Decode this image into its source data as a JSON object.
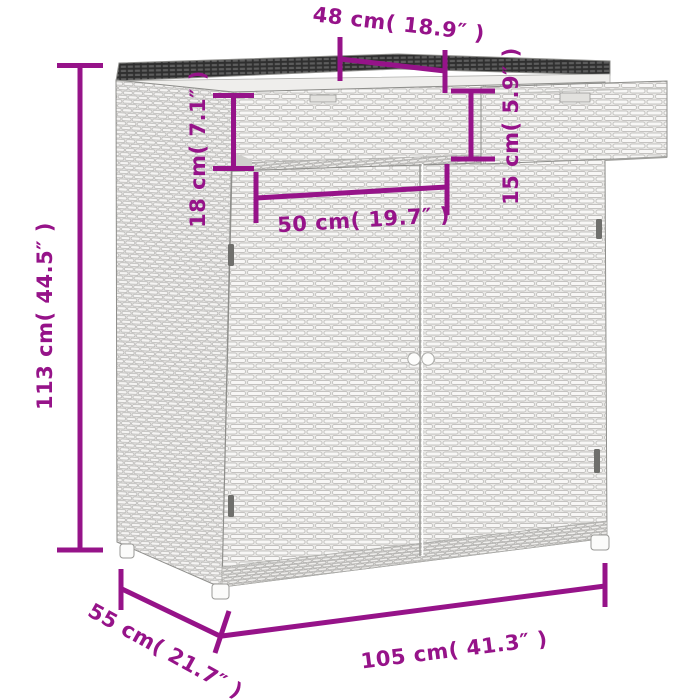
{
  "figure": {
    "type": "product-dimension-diagram"
  },
  "dimensions": {
    "top_width": "48 cm( 18.9″ )",
    "top_section_height": "18 cm( 7.1″ )",
    "extension_height": "15 cm( 5.9″ )",
    "door_width": "50 cm( 19.7″ )",
    "total_height": "113 cm( 44.5″ )",
    "depth": "55 cm( 21.7″ )",
    "total_width": "105 cm( 41.3″ )"
  },
  "colors": {
    "dimension_annotation": "#961389",
    "background": "#ffffff",
    "wicker_light": "#f0efed",
    "wicker_shade": "#b5b4b1",
    "top_dark": "#3d3d3d"
  }
}
